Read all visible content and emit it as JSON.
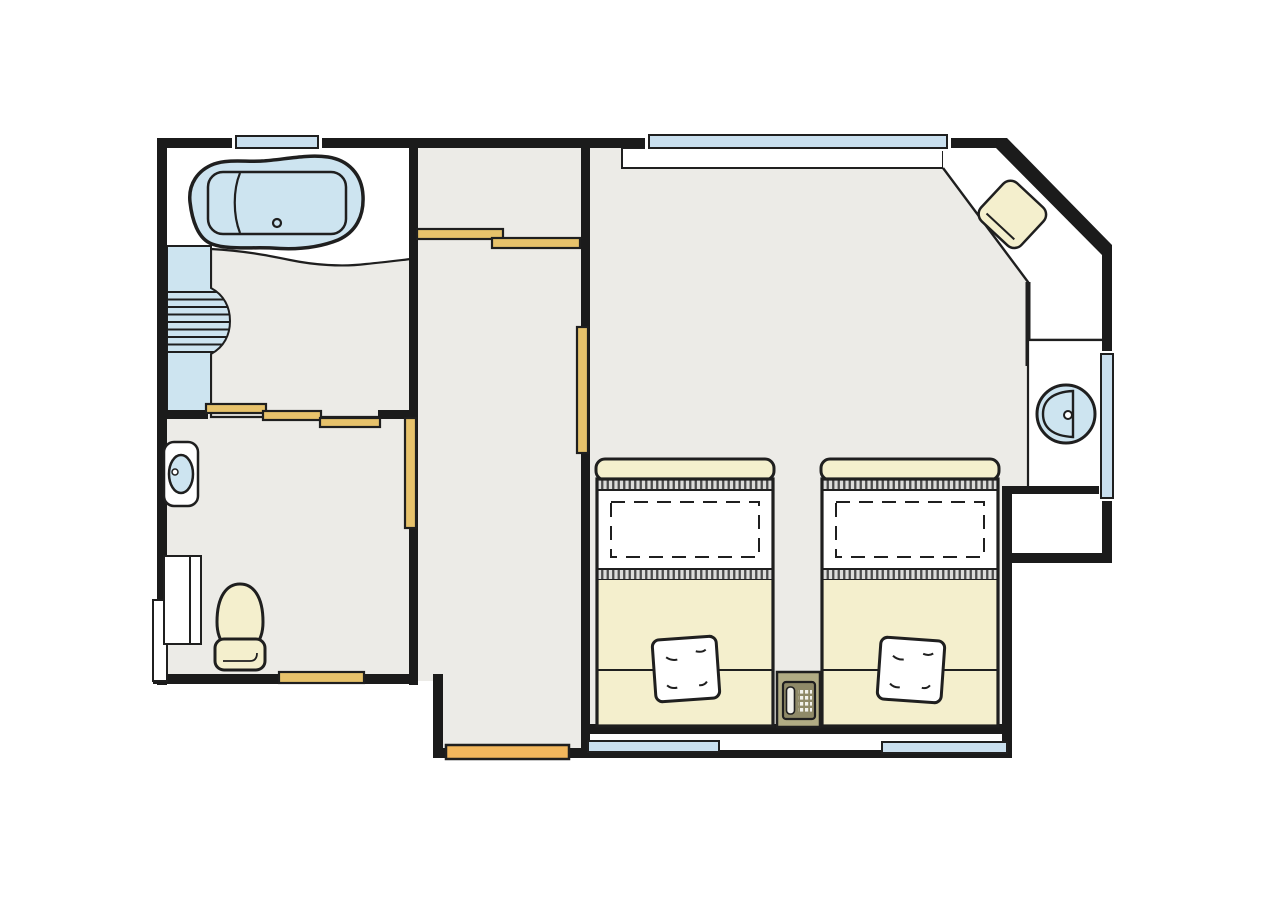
{
  "page": {
    "title": "hotel-guest-room-floor-plan",
    "background": "#ffffff"
  },
  "colors": {
    "wall": "#1b1b1b",
    "outline": "#1f1f1f",
    "floor": "#ecebe7",
    "white": "#ffffff",
    "water": "#cde4f0",
    "window": "#c9dfee",
    "cream": "#f4efcd",
    "door_tan": "#e7c26b",
    "door_orange": "#f2b75d",
    "nightstand_olive": "#b1ac84",
    "phone_body": "#8f8a68",
    "phone_light": "#f2f2ec",
    "hatch_bg": "#dcdcda",
    "hatch_line": "#4c4c4c"
  },
  "legend": {
    "rooms": [
      "bathroom",
      "toilet-room",
      "corridor",
      "bedroom",
      "entrance-vestibule"
    ],
    "fixtures": [
      "bathtub",
      "shower-panel",
      "hand-basin",
      "toilet",
      "storage-cabinet",
      "corner-desk",
      "desk-chair",
      "vanity-sink",
      "vanity-counter",
      "closet",
      "twin-bed-left",
      "twin-bed-right",
      "pillow-left",
      "pillow-right",
      "nightstand",
      "telephone"
    ],
    "openings": [
      "top-left-window",
      "bedroom-top-window",
      "right-wall-window",
      "bottom-window-left",
      "bottom-window-right",
      "corridor-sliding-door",
      "bathroom-sliding-door",
      "toilet-pocket-door",
      "bedroom-pocket-door",
      "toilet-rear-door",
      "entrance-door"
    ]
  }
}
